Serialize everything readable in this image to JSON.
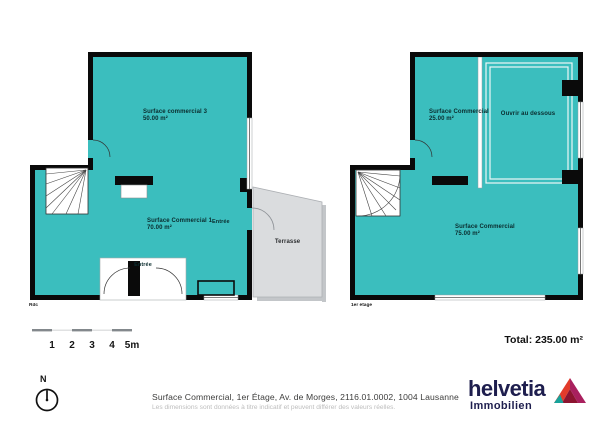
{
  "plans": {
    "ground": {
      "floor_label": "Rdc",
      "room_top": {
        "name": "Surface commercial 3",
        "area": "50.00 m²"
      },
      "room_bottom": {
        "name": "Surface Commercial 1",
        "area": "70.00 m²"
      },
      "entrance_side_label": "Entrée",
      "entrance_bottom_label": "Entrée",
      "terrace_label": "Terrasse"
    },
    "first": {
      "floor_label": "1er étage",
      "room_top": {
        "name": "Surface Commercial",
        "area": "25.00 m²"
      },
      "room_bottom": {
        "name": "Surface Commercial",
        "area": "75.00 m²"
      },
      "void_label": "Ouvrir au dessous"
    }
  },
  "scale": {
    "ticks": [
      "1",
      "2",
      "3",
      "4",
      "5m"
    ]
  },
  "compass": {
    "north_label": "N"
  },
  "total_label": "Total: 235.00 m²",
  "footer": {
    "address": "Surface Commercial, 1er Étage, Av. de Morges, 2116.01.0002, 1004 Lausanne",
    "disclaimer": "Les dimensions sont données à titre indicatif et peuvent différer des valeurs réelles.",
    "brand": "helvetia",
    "brand_sub": "Immobilien"
  },
  "colors": {
    "room_fill": "#3bbebe",
    "wall": "#0a0a0a",
    "terrace_fill": "#dadcde",
    "brand_navy": "#1e1e4e"
  }
}
